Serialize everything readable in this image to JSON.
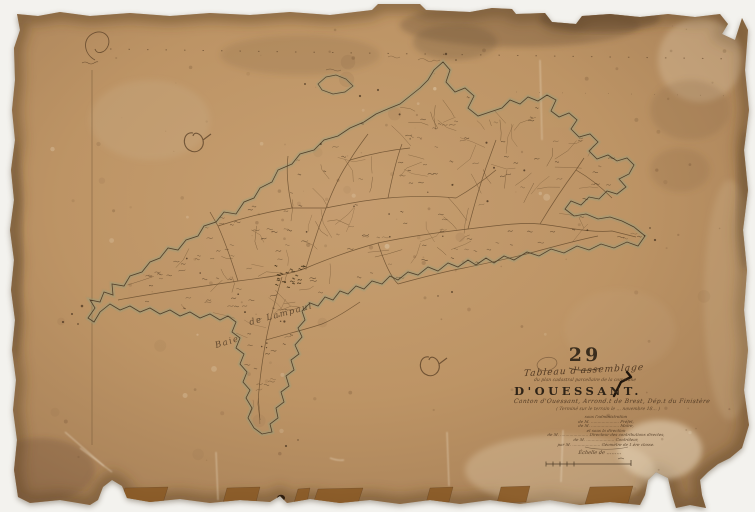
{
  "document": {
    "sheet_number": "29",
    "type_label": "Tableau d'assemblage",
    "subtitle": "du plan cadastral parcellaire de la commune",
    "title": "D'OUESSANT.",
    "canton_line": "Canton d'Ouessant, Arrond.t de Brest, Dép.t du Finistère",
    "completion_line": "( Terminé sur le terrain le … novembre 18… )",
    "admin_lines": [
      "sous l'administration",
      "de M. ………………… Préfet,",
      "de M. ………………… Maire,",
      "et sous la direction",
      "de M. ………………… Directeur des contributions directes,",
      "de M. ………………… Contrôleur,",
      "par M. ………………… Géomètre de 1.ère classe."
    ],
    "scale_label": "Échelle de ………"
  },
  "map": {
    "island_name": "Ouessant",
    "bay_label_word1": "Baie",
    "bay_label_word2": "de Lampaul"
  },
  "colors": {
    "paper": "#bd9465",
    "paper_edge": "#97744d",
    "ink": "#4a3520",
    "coast_tint": "#8ba083",
    "stain_dark": "#6f4f33",
    "repair_patch": "#8a5a26",
    "background": "#f3f2ee"
  }
}
